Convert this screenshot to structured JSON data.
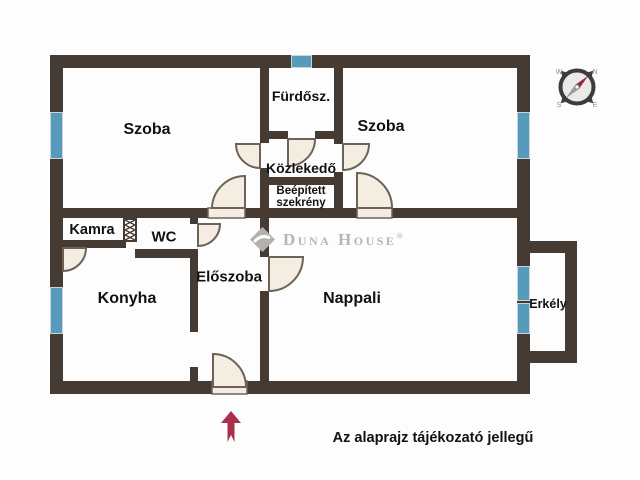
{
  "colors": {
    "wall": "#463b32",
    "win": "#579bbc",
    "win_frame": "#ccd4d8",
    "door_fill": "#f4eee2",
    "door_stroke": "#6e6257",
    "watermark": "#b7b5b2",
    "arrow": "#a8304d",
    "label": "#111111"
  },
  "rooms": [
    {
      "id": "szoba-left",
      "label": "Szoba"
    },
    {
      "id": "furdoszoba",
      "label": "Fürdősz."
    },
    {
      "id": "szoba-right",
      "label": "Szoba"
    },
    {
      "id": "kozlekedo",
      "label": "Közlekedő"
    },
    {
      "id": "szekreny",
      "label": "Beépített szekrény"
    },
    {
      "id": "kamra",
      "label": "Kamra"
    },
    {
      "id": "wc",
      "label": "WC"
    },
    {
      "id": "eloszoba",
      "label": "Előszoba"
    },
    {
      "id": "konyha",
      "label": "Konyha"
    },
    {
      "id": "nappali",
      "label": "Nappali"
    },
    {
      "id": "erkely",
      "label": "Erkély"
    }
  ],
  "watermark": {
    "brand": "Duna House",
    "registered": "®"
  },
  "compass": {
    "nw": "W",
    "ne": "N",
    "sw": "S",
    "se": "E"
  },
  "footer": {
    "note": "Az alaprajz tájékozató jellegű"
  }
}
